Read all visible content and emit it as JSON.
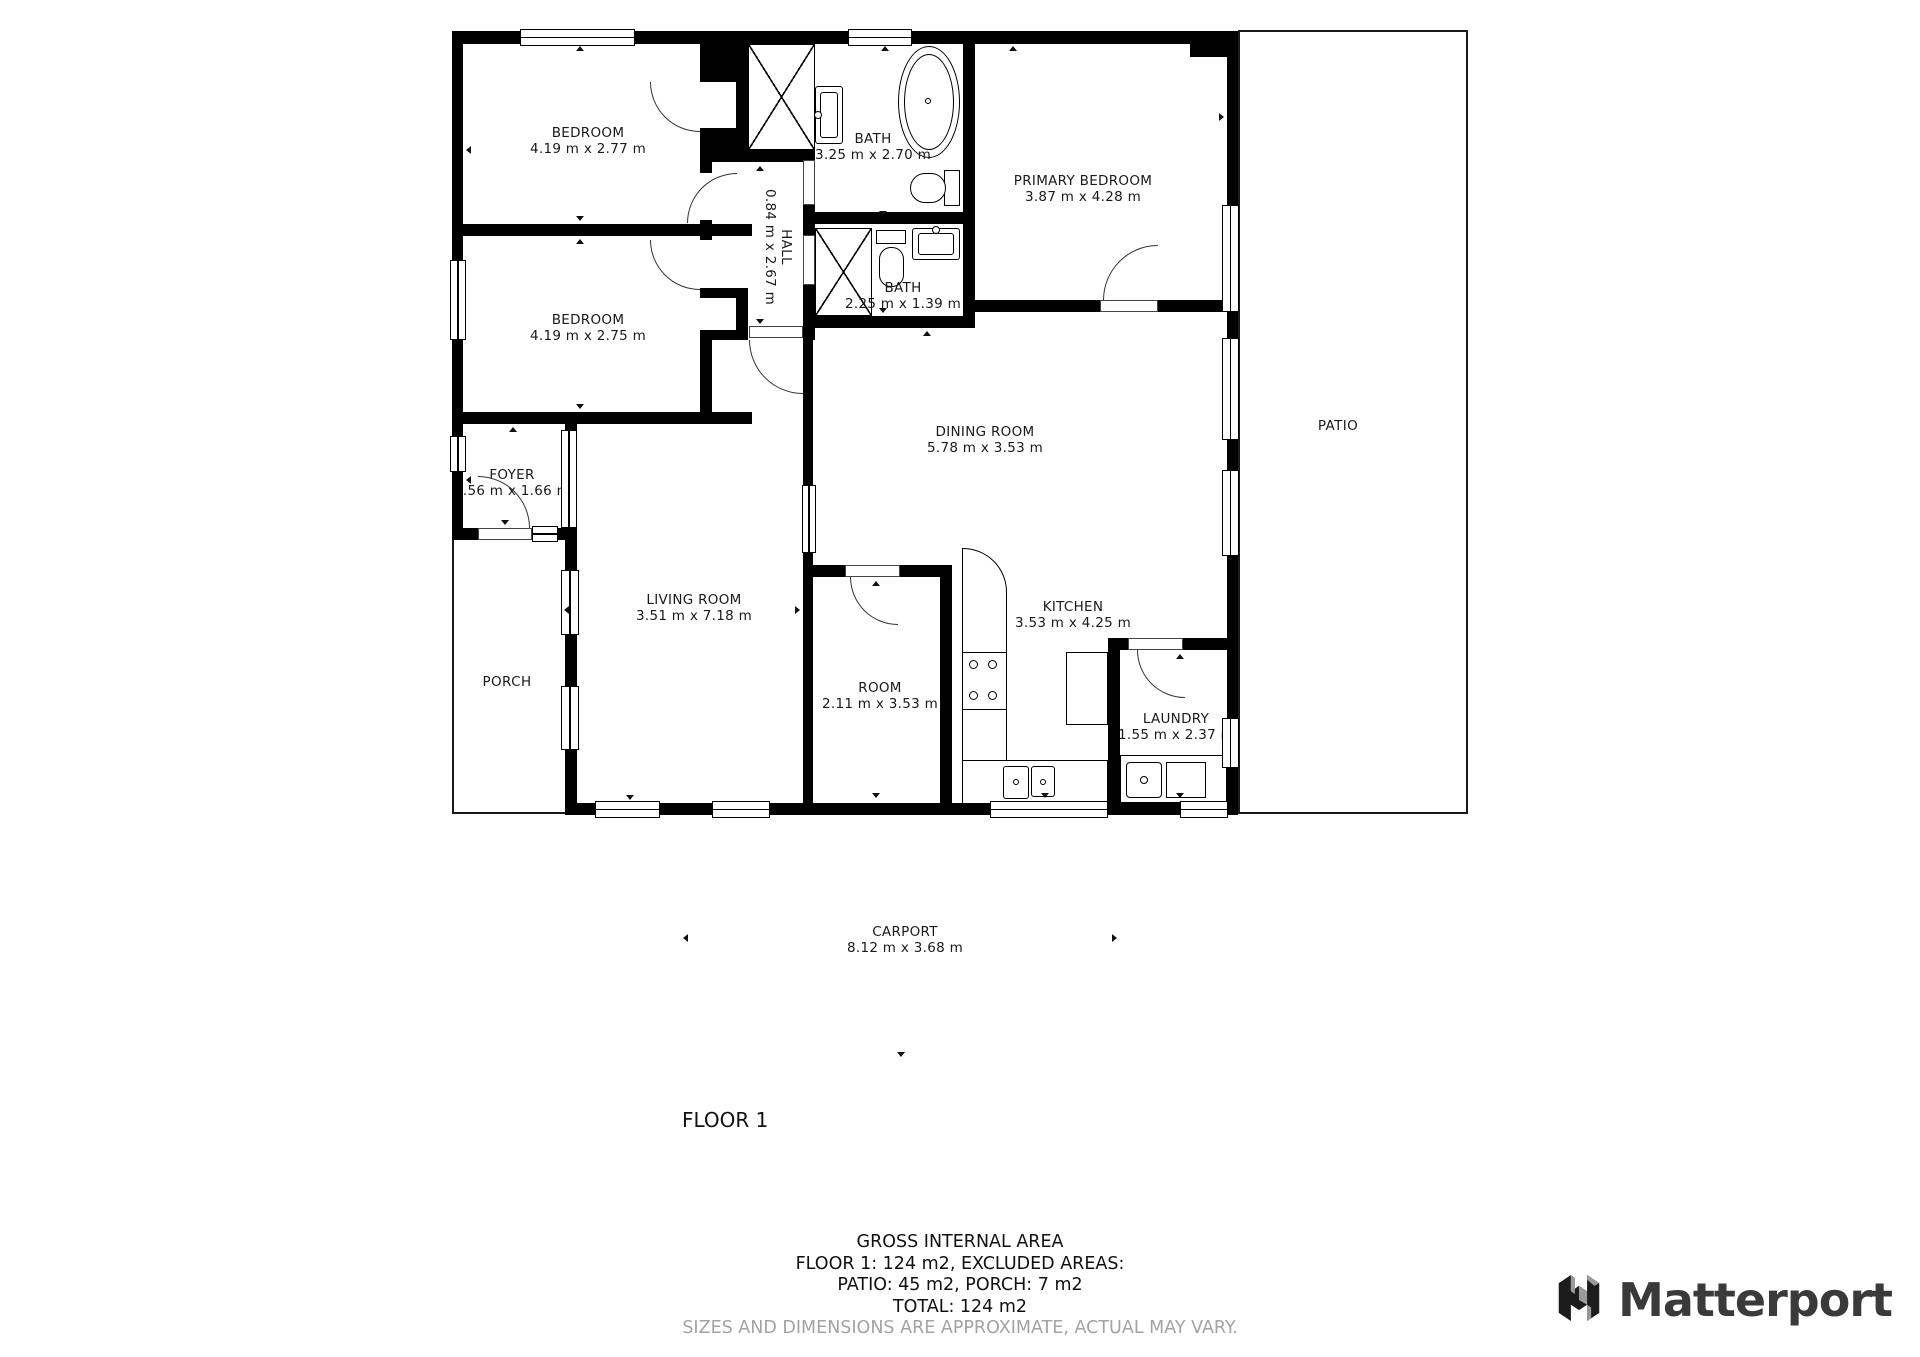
{
  "floorplan": {
    "rooms": [
      {
        "name": "BEDROOM",
        "dims": "4.19 m x 2.77 m"
      },
      {
        "name": "BEDROOM",
        "dims": "4.19 m x 2.75 m"
      },
      {
        "name": "BATH",
        "dims": "3.25 m x 2.70 m"
      },
      {
        "name": "BATH",
        "dims": "2.25 m x 1.39 m"
      },
      {
        "name": "HALL",
        "dims": "0.84 m x 2.67 m"
      },
      {
        "name": "PRIMARY BEDROOM",
        "dims": "3.87 m x 4.28 m"
      },
      {
        "name": "DINING ROOM",
        "dims": "5.78 m x 3.53 m"
      },
      {
        "name": "FOYER",
        "dims": "1.56 m x 1.66 m"
      },
      {
        "name": "LIVING ROOM",
        "dims": "3.51 m x 7.18 m"
      },
      {
        "name": "ROOM",
        "dims": "2.11 m x 3.53 m"
      },
      {
        "name": "KITCHEN",
        "dims": "3.53 m x 4.25 m"
      },
      {
        "name": "LAUNDRY",
        "dims": "1.55 m x 2.37 m"
      },
      {
        "name": "CARPORT",
        "dims": "8.12 m x 3.68 m"
      }
    ],
    "areas": [
      {
        "name": "PATIO"
      },
      {
        "name": "PORCH"
      }
    ],
    "floor_label": "FLOOR 1"
  },
  "summary": {
    "title": "GROSS INTERNAL AREA",
    "line1": "FLOOR 1: 124 m2, EXCLUDED AREAS:",
    "line2": "PATIO: 45 m2, PORCH: 7 m2",
    "line3": "TOTAL: 124 m2",
    "disclaimer": "SIZES AND DIMENSIONS ARE APPROXIMATE, ACTUAL MAY VARY."
  },
  "brand": {
    "name": "Matterport"
  },
  "colors": {
    "wall": "#000000",
    "text": "#1a1a1a",
    "muted": "#a3a3a3",
    "logo_text": "#3a3a3a"
  }
}
